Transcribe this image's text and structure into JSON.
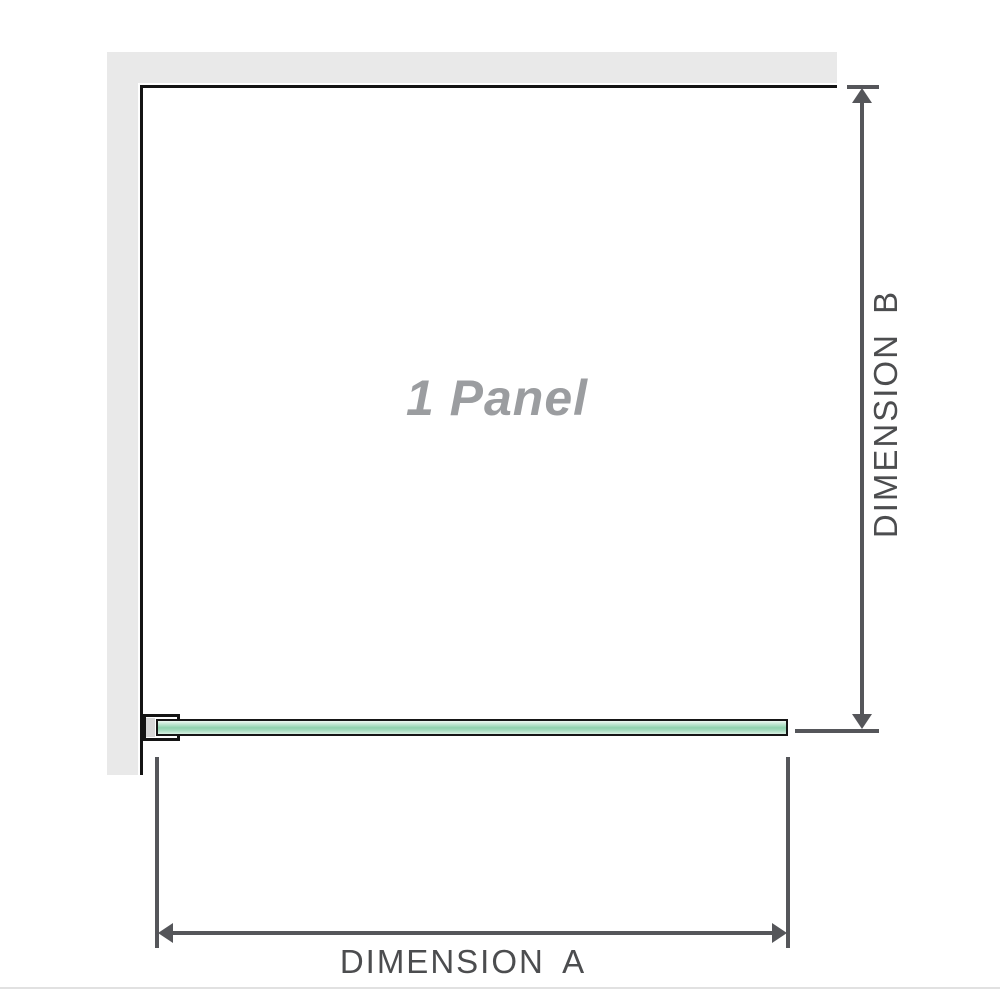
{
  "diagram": {
    "panel_label": "1 Panel",
    "dimension_a": {
      "label": "DIMENSION A",
      "orientation": "horizontal"
    },
    "dimension_b": {
      "label": "DIMENSION B",
      "orientation": "vertical"
    }
  },
  "colors": {
    "wall": "#e9e9e9",
    "outline": "#141414",
    "dimension_lines": "#55565a",
    "dimension_text": "#4c4d4f",
    "panel_label_text": "#9b9da0",
    "glass_light": "#c4e8d4",
    "glass_dark": "#8fd2ae",
    "bracket_spacer": "#d8d8d8",
    "bottom_divider": "#e1e1e1"
  }
}
